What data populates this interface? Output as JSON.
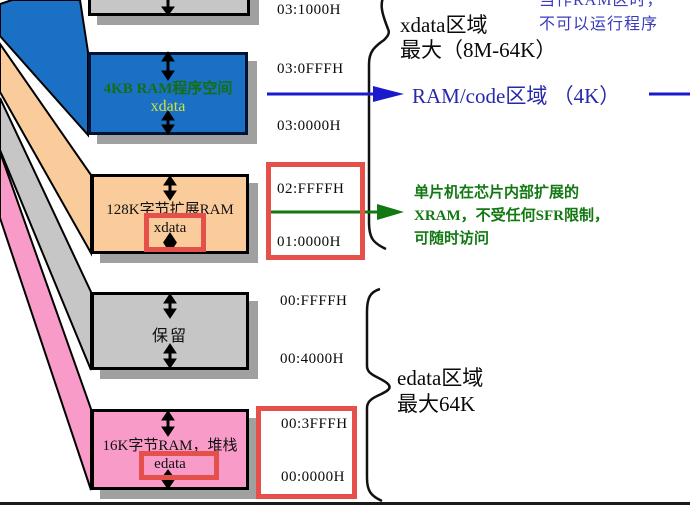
{
  "diagram": {
    "boxes": {
      "ram4k": {
        "title": "4KB RAM程序空间",
        "subtitle": "xdata"
      },
      "xram128k": {
        "title": "128K字节扩展RAM",
        "subtitle": "xdata"
      },
      "reserved": {
        "title": "保留"
      },
      "ram16k": {
        "title": "16K字节RAM，堆栈",
        "subtitle": "edata"
      }
    },
    "addresses": [
      "03:1000H",
      "03:0FFFH",
      "03:0000H",
      "02:FFFFH",
      "01:0000H",
      "00:FFFFH",
      "00:4000H",
      "00:3FFFH",
      "00:0000H"
    ],
    "regions": {
      "xdata": {
        "line1": "xdata区域",
        "line2": "最大（8M-64K）"
      },
      "ramcode": {
        "label": "RAM/code区域 （4K）"
      },
      "edata": {
        "line1": "edata区域",
        "line2": "最大64K"
      }
    },
    "notes": {
      "top_right": {
        "line1": "当作RAM区时，",
        "line2": "不可以运行程序"
      },
      "xram": {
        "line1": "单片机在芯片内部扩展的",
        "line2": "XRAM，不受任何SFR限制，",
        "line3": "可随时访问"
      }
    },
    "colors": {
      "blue_box": "#1a70c4",
      "orange_box": "#facc9b",
      "gray_box": "#c6c6c6",
      "pink_box": "#f99bc8",
      "red_highlight": "#e5504b",
      "green_accent": "#127812",
      "blue_arrow": "#1a1acc",
      "blue_label": "#2828ac",
      "note_blue": "#3a3abc",
      "shadow": "#a0a0a0"
    }
  }
}
